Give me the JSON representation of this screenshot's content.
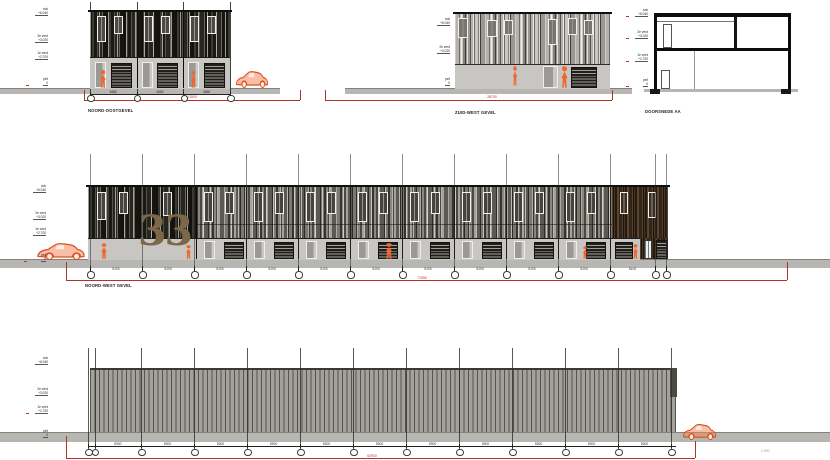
{
  "labels": {
    "d1": "NOORD-OOSTGEVEL",
    "d2": "ZUID-WEST GEVEL",
    "d3": "DOORSNEDE AA",
    "d4": "NOORD-WEST GEVEL"
  },
  "house_number": "33",
  "scale_note": "1:200",
  "levels": [
    {
      "name": "nok",
      "value": "+6.040"
    },
    {
      "name": "2e verd",
      "value": "+3.020"
    },
    {
      "name": "1e verd",
      "value": "+2.700"
    },
    {
      "name": "peil",
      "value": "0"
    }
  ],
  "dimensions": {
    "d1": {
      "units": [
        "4680",
        "4680",
        "4680"
      ],
      "total": "21500"
    },
    "d2": {
      "total": "28700"
    },
    "d4": {
      "unit": "5100",
      "total": "71950"
    },
    "d5": {
      "unit": "5300",
      "total": "62900"
    }
  },
  "colors": {
    "accent_orange": "#f1662f",
    "dimension_red": "#b33226",
    "house_number_bronze": "#7c6749"
  }
}
